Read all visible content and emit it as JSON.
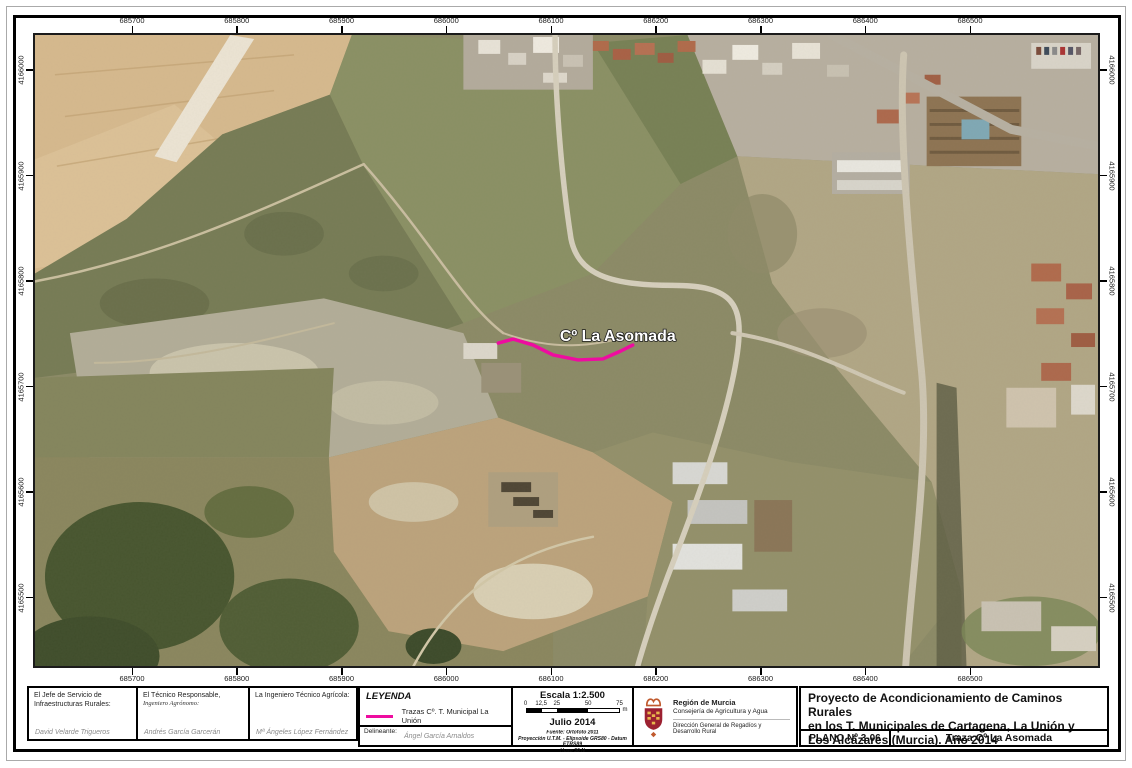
{
  "map": {
    "road_label": "Cº La Asomada",
    "trace_color": "#ee0ca0",
    "x_labels": [
      "685700",
      "685800",
      "685900",
      "686000",
      "686100",
      "686200",
      "686300",
      "686400",
      "686500"
    ],
    "y_labels": [
      "4166000",
      "4165900",
      "4165800",
      "4165700",
      "4165600",
      "4165500"
    ]
  },
  "footer": {
    "signatures": [
      {
        "title": "El Jefe de Servicio de Infraestructuras Rurales:",
        "subtitle": "",
        "name": "David Velarde Trigueros"
      },
      {
        "title": "El Técnico Responsable,",
        "subtitle": "Ingeniero Agrónomo:",
        "name": "Andrés García Garcerán"
      },
      {
        "title": "La Ingeniero Técnico Agrícola:",
        "subtitle": "",
        "name": "Mª Ángeles López Fernández"
      }
    ],
    "legend": {
      "title": "LEYENDA",
      "item_label": "Trazas Cº. T. Municipal La Unión",
      "delineante_label": "Delineante:",
      "delineante_name": "Ángel García Arnaldos"
    },
    "scale": {
      "title": "Escala 1:2.500",
      "ticks": [
        "0",
        "12,5",
        "25",
        "50",
        "75"
      ],
      "unit": "m",
      "date": "Julio 2014",
      "source": "Fuente: Ortofoto 2011",
      "projection": "Proyección U.T.M. - Elipsoide GRS80 - Datum ETRS89",
      "zone": "Huso 30 N"
    },
    "agency": {
      "region": "Región de Murcia",
      "department": "Consejería de Agricultura y Agua",
      "directorate": "Dirección General de Regadíos y Desarrollo Rural",
      "shield_color": "#9c2131"
    },
    "title_block": {
      "project_line1": "Proyecto de Acondicionamiento de Caminos Rurales",
      "project_line2": "en los T. Municipales de Cartagena, La Unión y",
      "project_line3": "Los Alcázares (Murcia). Año 2014",
      "plano_label": "PLANO Nº 3-06",
      "plano_title": "Traza Cº La Asomada"
    }
  }
}
